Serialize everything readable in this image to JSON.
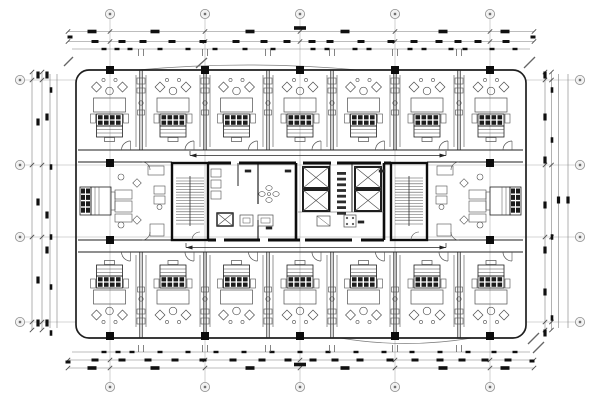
{
  "meta": {
    "kind": "architectural-floor-plan",
    "subject": "hotel guest-room floor CAD plan with central elevator-stair core, perimeter dimension strings and column grid bubbles",
    "width": 600,
    "height": 400,
    "grid_bubble_label": ""
  },
  "colors": {
    "background": "#ffffff",
    "wall": "#1f1f1f",
    "heavy": "#0d0d0d",
    "thin": "#4f4f4f",
    "faint": "#7d7d7d",
    "grid": "#ababab",
    "dash": "#101010",
    "hatch": "#555555",
    "bubble_fill": "#f2f2f2",
    "bubble_stroke": "#8c8c8c",
    "bubble_dot": "#6f6f6f"
  },
  "building": {
    "x": 76,
    "y": 70,
    "w": 450,
    "h": 268,
    "corner_radius": 13
  },
  "grid": {
    "vertical_x": [
      110,
      205,
      300,
      395,
      490
    ],
    "horizontal_y": [
      80,
      165,
      237,
      322
    ],
    "bubble_radius": 4.6,
    "top_bubble_y": 14,
    "bottom_bubble_y": 387,
    "left_bubble_x": 20,
    "right_bubble_x": 580
  },
  "rooms": {
    "boundaries": [
      78,
      141,
      205,
      268,
      332,
      395,
      459,
      523
    ],
    "top_band": [
      70,
      150
    ],
    "bottom_band": [
      252,
      338
    ]
  },
  "end_suites": {
    "left_x1": 78,
    "left_x2": 172,
    "right_x1": 429,
    "right_x2": 523
  },
  "corridors": {
    "top": [
      150,
      162
    ],
    "bottom": [
      240,
      252
    ],
    "arrows": [
      {
        "x1": 190,
        "x2": 446,
        "y": 155.5
      },
      {
        "x1": 186,
        "x2": 446,
        "y": 247.5
      }
    ]
  },
  "core": {
    "x1": 172,
    "x2": 427,
    "y1": 163,
    "y2": 240,
    "stairs": [
      {
        "x": 172
      },
      {
        "x": 391
      }
    ],
    "stair_w": 36,
    "stair_h": 77,
    "elevator_shafts": [
      [
        303,
        167
      ],
      [
        303,
        190
      ],
      [
        355,
        167
      ],
      [
        355,
        190
      ]
    ],
    "shaft_w": 26,
    "shaft_h": 21,
    "top_wall_segments": [
      [
        208,
        231
      ],
      [
        239,
        296
      ],
      [
        303,
        331
      ],
      [
        337,
        381
      ],
      [
        384,
        391
      ]
    ],
    "bottom_wall_segments": [
      [
        208,
        216
      ],
      [
        224,
        260
      ],
      [
        268,
        300
      ],
      [
        305,
        352
      ],
      [
        361,
        384
      ]
    ],
    "partitions": [
      [
        296,
        163,
        296,
        240,
        2.6
      ],
      [
        384,
        163,
        384,
        240,
        2.6
      ],
      [
        258,
        163,
        258,
        204,
        1.1
      ],
      [
        258,
        220,
        258,
        240,
        1.1
      ],
      [
        330,
        163,
        330,
        212,
        0.9
      ],
      [
        352,
        163,
        352,
        212,
        0.9
      ],
      [
        238,
        163,
        238,
        186,
        0.9
      ]
    ],
    "lobby_floor_line": [
      298,
      212,
      384,
      212
    ],
    "service_shaft": [
      217,
      213,
      16,
      13
    ],
    "wc_stalls": [
      [
        211,
        169
      ],
      [
        211,
        180
      ],
      [
        211,
        191
      ]
    ],
    "sink_cluster": {
      "cx": 269,
      "cy": 194
    },
    "small_rooms": [
      [
        240,
        215,
        13,
        11
      ],
      [
        258,
        215,
        15,
        11
      ]
    ],
    "fixtures": [
      [
        317,
        216,
        13,
        10
      ],
      [
        344,
        215,
        12,
        12
      ]
    ],
    "label_column": {
      "x": 341.5,
      "y0": 172,
      "step": 5.7,
      "count": 8
    },
    "room_dashes": [
      [
        248,
        171
      ],
      [
        269,
        228
      ],
      [
        361,
        222
      ],
      [
        382,
        171
      ],
      [
        288,
        171
      ]
    ]
  },
  "columns": {
    "size": 8,
    "positions": [
      [
        110,
        70
      ],
      [
        205,
        70
      ],
      [
        300,
        70
      ],
      [
        395,
        70
      ],
      [
        490,
        70
      ],
      [
        110,
        336
      ],
      [
        205,
        336
      ],
      [
        300,
        336
      ],
      [
        395,
        336
      ],
      [
        490,
        336
      ],
      [
        110,
        163
      ],
      [
        110,
        240
      ],
      [
        490,
        163
      ],
      [
        490,
        240
      ]
    ]
  },
  "dimensions": {
    "top_lines": [
      {
        "y": 31.5,
        "x1": 68,
        "x2": 534
      },
      {
        "y": 41.5,
        "x1": 68,
        "x2": 534
      },
      {
        "y": 49,
        "x1": 72,
        "x2": 530
      }
    ],
    "bottom_lines": [
      {
        "y": 352,
        "x1": 72,
        "x2": 530
      },
      {
        "y": 360,
        "x1": 68,
        "x2": 534
      },
      {
        "y": 368,
        "x1": 68,
        "x2": 534
      }
    ],
    "left_lines": [
      {
        "x": 32,
        "y1": 72,
        "y2": 330
      },
      {
        "x": 42,
        "y1": 72,
        "y2": 330
      },
      {
        "x": 50,
        "y1": 74,
        "y2": 328
      },
      {
        "x": 57,
        "y1": 74,
        "y2": 328
      }
    ],
    "right_lines": [
      {
        "x": 545,
        "y1": 72,
        "y2": 330
      },
      {
        "x": 551.5,
        "y1": 72,
        "y2": 330
      },
      {
        "x": 558.5,
        "y1": 74,
        "y2": 328
      },
      {
        "x": 568,
        "y1": 74,
        "y2": 328
      }
    ],
    "top_rows": [
      {
        "y": 31.5,
        "size": [
          9,
          3.6
        ],
        "xs": [
          92,
          155,
          250,
          345,
          443,
          505
        ]
      },
      {
        "y": 28,
        "size": [
          12,
          3.6
        ],
        "xs": [
          300
        ]
      },
      {
        "y": 41.5,
        "size": [
          7,
          3
        ],
        "xs": [
          95,
          122,
          143,
          172,
          203,
          236,
          264,
          287,
          312,
          330,
          361,
          391,
          414,
          439,
          458,
          478,
          506
        ]
      },
      {
        "y": 49,
        "size": [
          5,
          2.4
        ],
        "xs": [
          104,
          117,
          130,
          160,
          188,
          215,
          245,
          273,
          313,
          327,
          355,
          369,
          410,
          424,
          451,
          465,
          492,
          515
        ]
      }
    ],
    "bottom_rows": [
      {
        "y": 368,
        "size": [
          9,
          3.6
        ],
        "xs": [
          92,
          155,
          250,
          345,
          443,
          505
        ]
      },
      {
        "y": 364.5,
        "size": [
          12,
          3.6
        ],
        "xs": [
          300
        ]
      },
      {
        "y": 360,
        "size": [
          7,
          3
        ],
        "xs": [
          95,
          122,
          148,
          175,
          203,
          233,
          262,
          288,
          313,
          335,
          360,
          390,
          415,
          440,
          462,
          485,
          508
        ]
      },
      {
        "y": 352,
        "size": [
          5,
          2.4
        ],
        "xs": [
          104,
          118,
          132,
          160,
          188,
          216,
          244,
          272,
          300,
          328,
          356,
          384,
          412,
          440,
          468,
          494,
          515
        ]
      }
    ],
    "left_cols": [
      {
        "x": 38,
        "size": [
          3.2,
          7
        ],
        "ys": [
          75,
          122,
          202,
          280,
          323
        ]
      },
      {
        "x": 47,
        "size": [
          3.2,
          7
        ],
        "ys": [
          75,
          117,
          215,
          250,
          323
        ]
      },
      {
        "x": 51,
        "size": [
          2.6,
          5.5
        ],
        "ys": [
          90,
          167,
          237,
          287,
          333
        ]
      }
    ],
    "right_cols": [
      {
        "x": 545,
        "size": [
          3.2,
          7
        ],
        "ys": [
          75,
          117,
          160,
          205,
          250,
          292,
          333
        ]
      },
      {
        "x": 552,
        "size": [
          2.6,
          5.5
        ],
        "ys": [
          90,
          140,
          237,
          318
        ]
      },
      {
        "x": 558.5,
        "size": [
          3.2,
          7
        ],
        "ys": [
          200
        ]
      },
      {
        "x": 568,
        "size": [
          3.2,
          7
        ],
        "ys": [
          200
        ]
      }
    ],
    "tick_pair_x": [
      141,
      205,
      268,
      332,
      395,
      459
    ],
    "tick_xs": [
      68,
      110,
      205,
      300,
      395,
      490,
      534
    ],
    "tick_ys": [
      72,
      80,
      165,
      237,
      322,
      330
    ]
  },
  "decor": {
    "canopies": [
      "M137,70 Q248,60 358,70",
      "M340,338 Q406,349 472,338"
    ],
    "corner_ticks": [
      [
        64,
        66,
        73,
        57
      ],
      [
        196,
        68,
        207,
        58
      ],
      [
        524,
        68,
        535,
        57
      ],
      [
        528,
        344,
        539,
        333
      ],
      [
        533,
        353,
        544,
        342
      ]
    ],
    "edge_dashes": [
      [
        70,
        37
      ],
      [
        533,
        37
      ],
      [
        68,
        362
      ],
      [
        532,
        361
      ]
    ]
  }
}
